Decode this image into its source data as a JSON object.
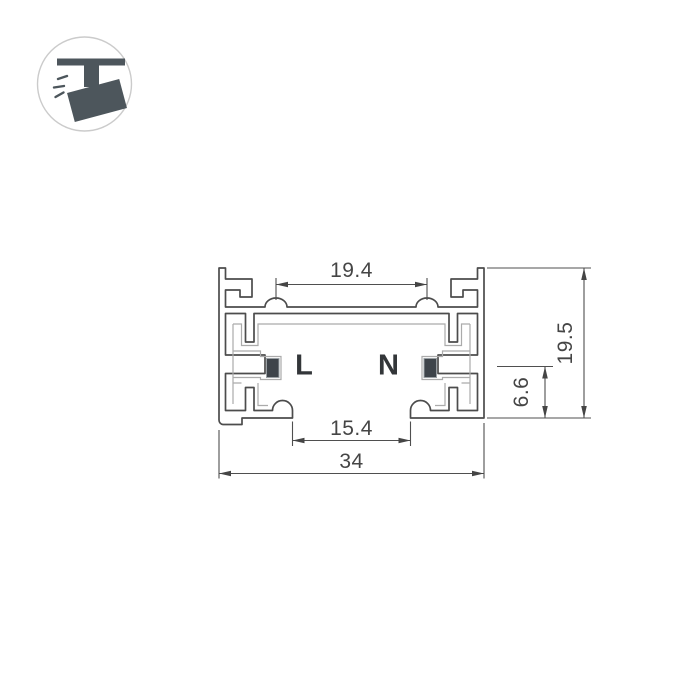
{
  "drawing": {
    "type": "technical-cross-section",
    "subject": "track busbar profile cross-section",
    "conductor_labels": {
      "left": "L",
      "right": "N"
    },
    "dimensions": {
      "top_width": "19.4",
      "overall_height": "19.5",
      "contact_height": "6.6",
      "opening_width": "15.4",
      "overall_width": "34"
    },
    "colors": {
      "outline": "#4c4c4c",
      "insulator": "#ababab",
      "contact_fill": "#3e444a",
      "dimension": "#454545"
    }
  },
  "icon": {
    "name": "track-spotlight",
    "color": "#4d565c",
    "circle_border": "#cbcbcb"
  }
}
